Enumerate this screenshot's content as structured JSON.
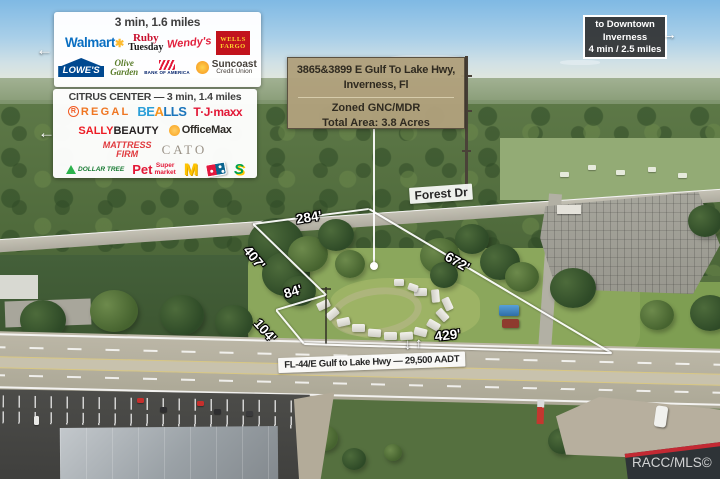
{
  "plaza_west": {
    "header": "3 min, 1.6 miles",
    "walmart": "Walmart",
    "walmart_spark": "✱",
    "ruby_line1": "Ruby",
    "ruby_line2": "Tuesday",
    "wendys": "Wendy's",
    "wells_line1": "WELLS",
    "wells_line2": "FARGO",
    "lowes": "LOWE'S",
    "olive_line1": "Olive",
    "olive_line2": "Garden",
    "boa": "BANK OF AMERICA",
    "suncoast_line1": "Suncoast",
    "suncoast_line2": "Credit Union"
  },
  "plaza_citrus": {
    "header": "CITRUS CENTER — 3 min, 1.4 miles",
    "regal_r": "R",
    "regal": "REGAL",
    "bealls_1": "BE",
    "bealls_2": "A",
    "bealls_3": "LLS",
    "tjmaxx": "T·J·maxx",
    "sally_1": "SALLY",
    "sally_2": "BEAUTY",
    "officemax": "OfficeMax",
    "mattress_1": "MATTRESS",
    "mattress_2": "FIRM",
    "cato": "CATO",
    "dollar_tree": "DOLLAR TREE",
    "pet_1": "Pet",
    "pet_2": "Super",
    "pet_3": "market",
    "mcdonalds": "M",
    "subway": "S"
  },
  "property_box": {
    "address_line1": "3865&3899 E Gulf To Lake Hwy,",
    "address_line2": "Inverness, Fl",
    "zoning": "Zoned GNC/MDR",
    "total_area": "Total Area: 3.8 Acres"
  },
  "downtown_box": {
    "line1": "to Downtown",
    "line2": "Inverness",
    "line3": "4 min / 2.5 miles",
    "arrow": "→"
  },
  "map_labels": {
    "forest_dr": "Forest Dr",
    "highway": "FL-44/E Gulf to Lake Hwy — 29,500 AADT",
    "dim_284": "284'",
    "dim_407": "407'",
    "dim_84": "84'",
    "dim_104": "104'",
    "dim_672": "672'",
    "dim_429": "429'",
    "arrow_down": "↓",
    "arrow_up": "↑",
    "arrow_left": "←",
    "watermark": "RACC/MLS©"
  },
  "colors": {
    "property_box_bg": "#b0a07c",
    "property_box_border": "#5b5140",
    "downtown_box_bg": "#2d2d2d",
    "boundary_line": "#ffffff",
    "walmart_blue": "#0a6fc2",
    "walmart_yellow": "#fdbb30",
    "wells_fargo_red": "#c2131d",
    "lowes_blue": "#004990",
    "mcdonalds_yellow": "#ffc400",
    "subway_green": "#00a14b",
    "dominos_red": "#e3173e",
    "dominos_blue": "#0b648f"
  }
}
